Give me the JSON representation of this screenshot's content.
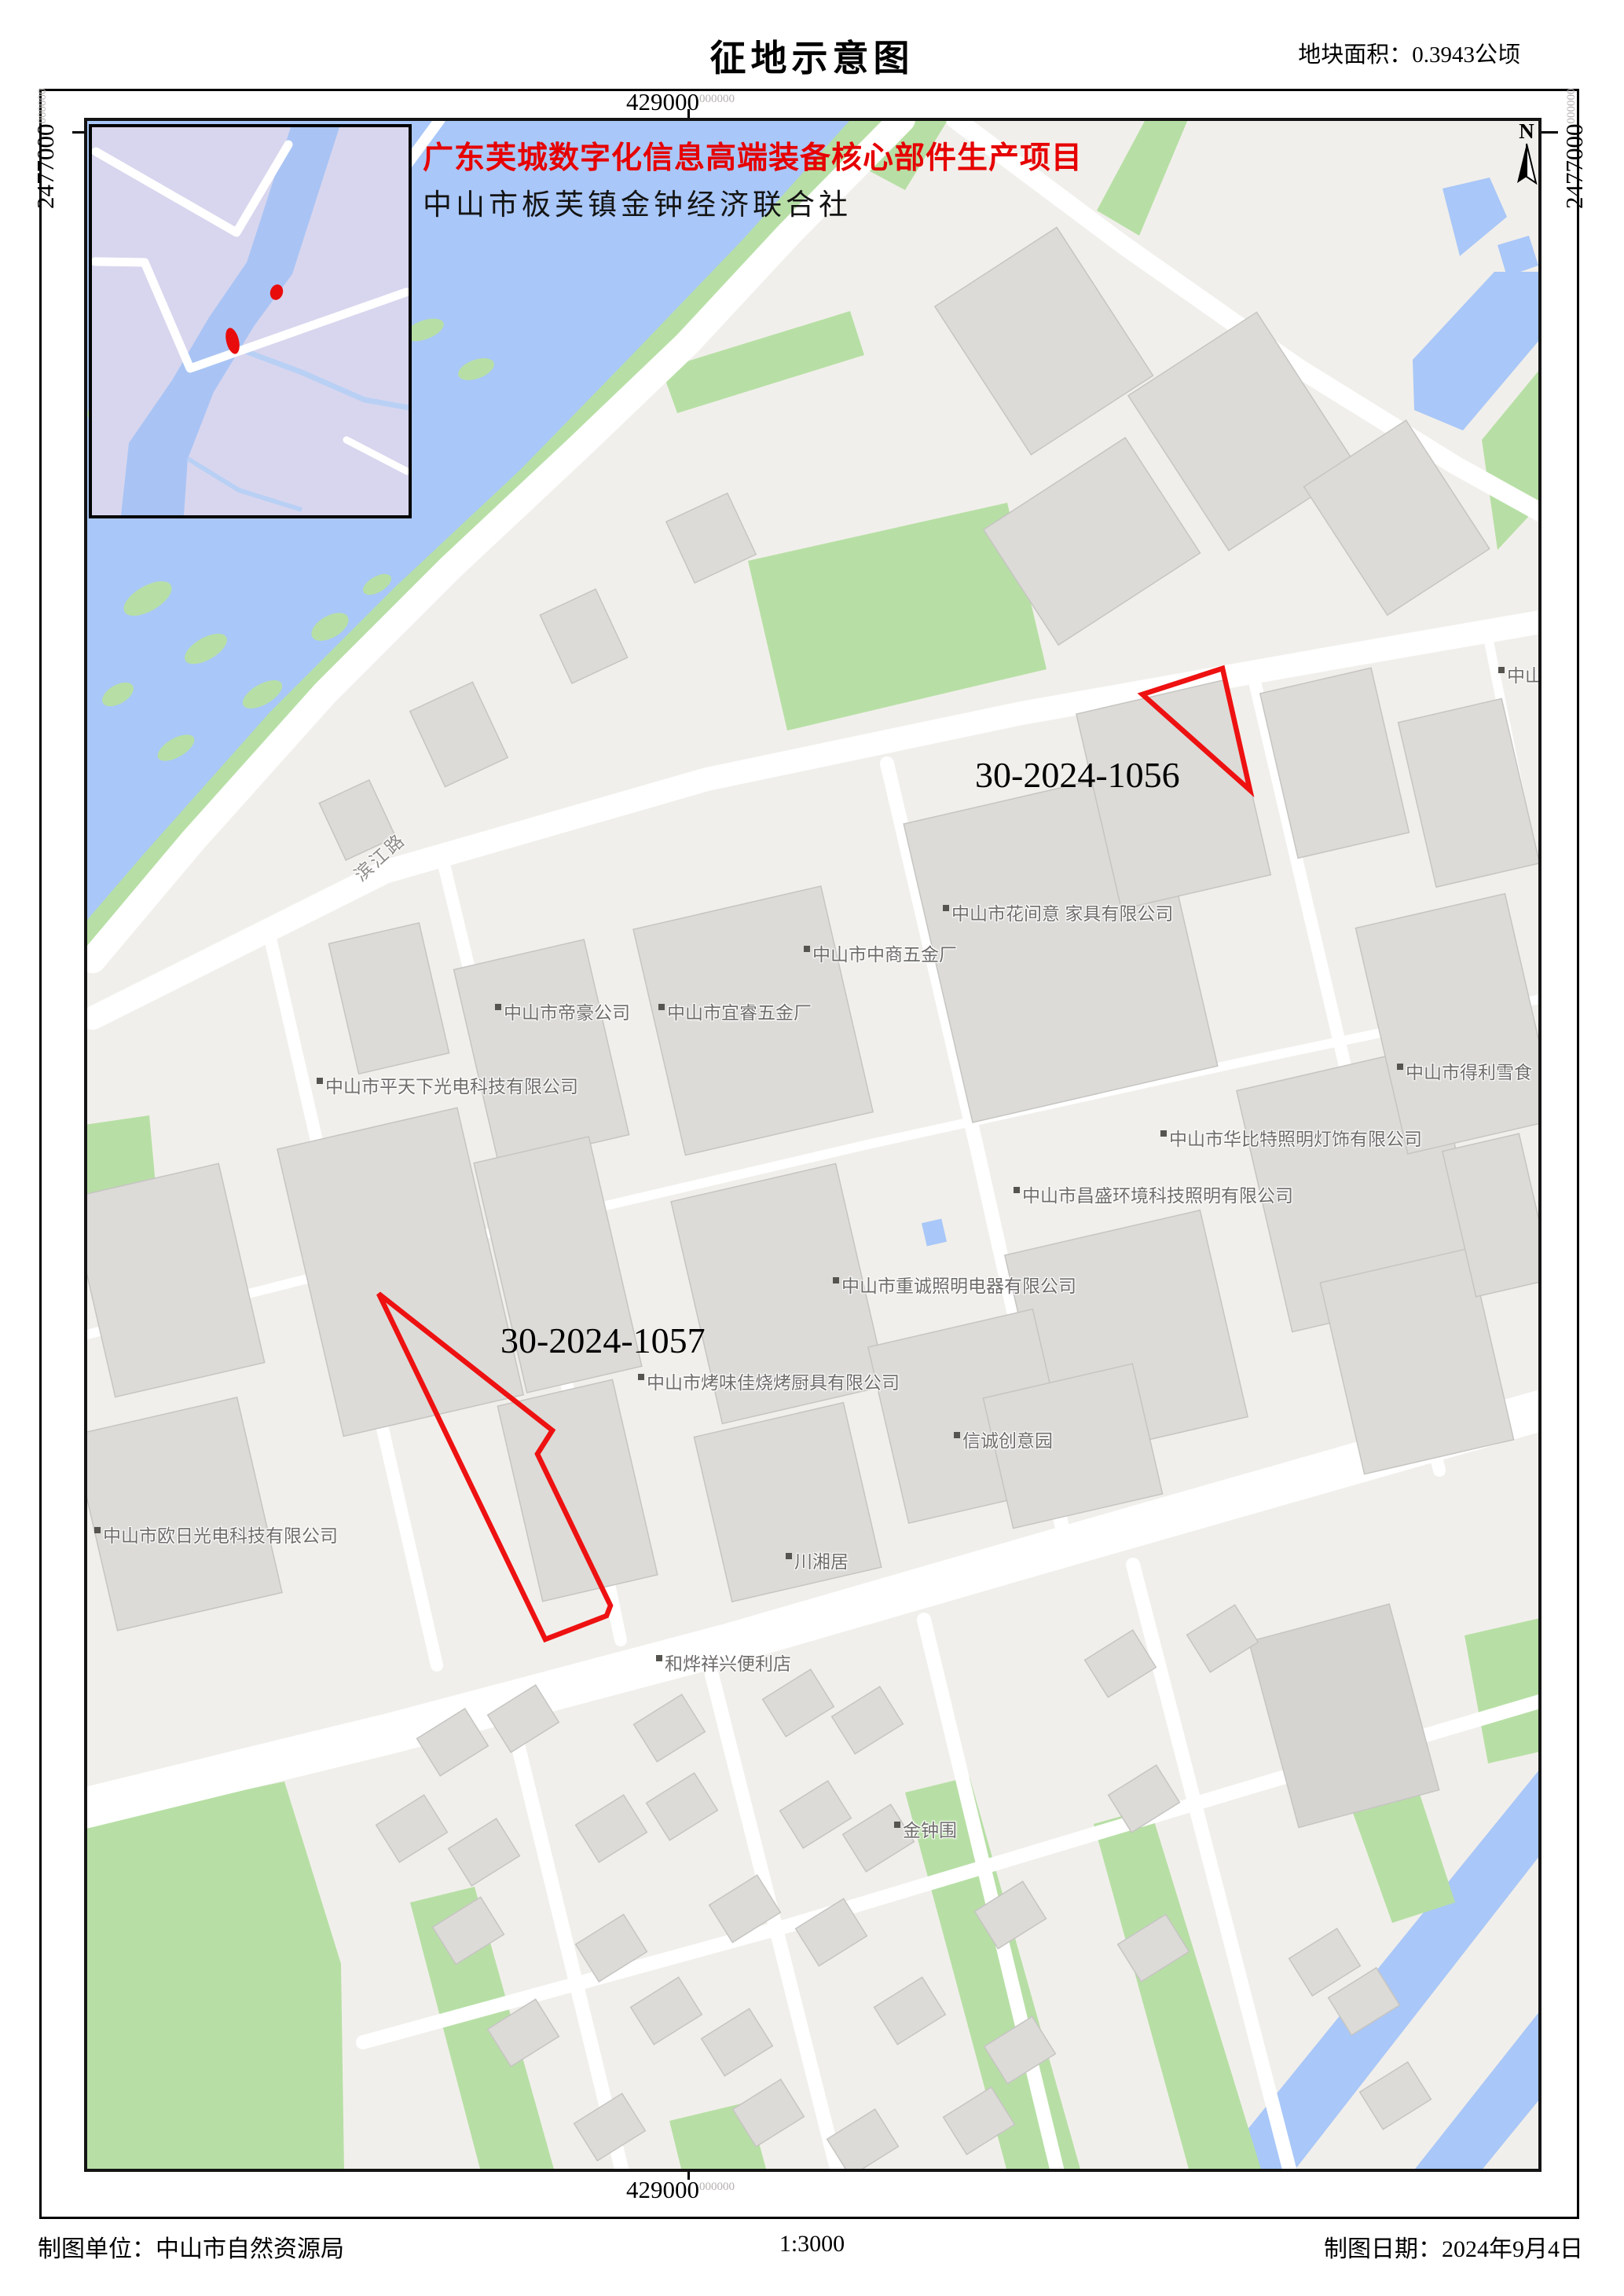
{
  "header": {
    "title": "征地示意图",
    "area_note": "地块面积：0.3943公顷"
  },
  "project": {
    "name": "广东芙城数字化信息高端装备核心部件生产项目",
    "applicant": "中山市板芙镇金钟经济联合社"
  },
  "coords": {
    "easting": "429000",
    "northing": "2477000",
    "sub": "000000"
  },
  "parcels": {
    "p1056": "30-2024-1056",
    "p1057": "30-2024-1057"
  },
  "north": "N",
  "labels": {
    "huajianyi": "中山市花间意 家具有限公司",
    "zhongshang": "中山市中商五金厂",
    "dihao": "中山市帝豪公司",
    "yirui": "中山市宜睿五金厂",
    "pingtianxia": "中山市平天下光电科技有限公司",
    "delixue": "中山市得利雪食",
    "huabite": "中山市华比特照明灯饰有限公司",
    "changsheng": "中山市昌盛环境科技照明有限公司",
    "zhongcheng": "中山市重诚照明电器有限公司",
    "kaoweijia": "中山市烤味佳烧烤厨具有限公司",
    "xincheng": "信诚创意园",
    "chuanxiangju": "川湘居",
    "ouri": "中山市欧日光电科技有限公司",
    "heye": "和烨祥兴便利店",
    "jinzhongwei": "金钟围",
    "binjianglu": "滨江路",
    "edge_partial": "中山"
  },
  "footer": {
    "agency": "制图单位：中山市自然资源局",
    "scale": "1:3000",
    "date": "制图日期：2024年9月4日"
  },
  "colors": {
    "water": "#a9c7f8",
    "green": "#b7dfa5",
    "land": "#f1efeb",
    "building": "#dcdbd8",
    "parcel_outline": "#ee1111",
    "inset_land": "#d8d6ee",
    "project_red": "#e60000"
  }
}
